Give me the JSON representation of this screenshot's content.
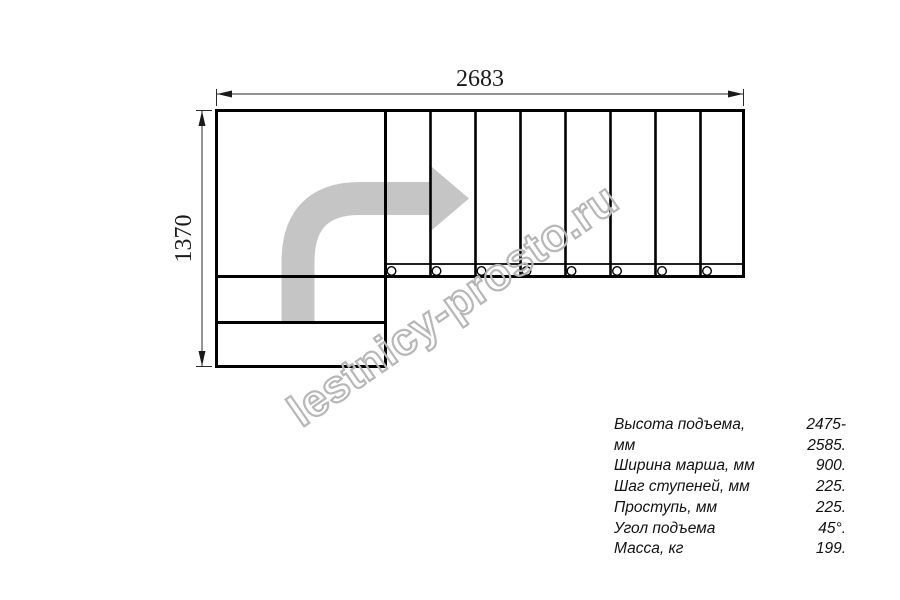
{
  "drawing": {
    "type": "l-shaped-staircase-plan-top-view",
    "dim_width": "2683",
    "dim_height": "1370",
    "treads_count": 8,
    "mount_holes_count": 8,
    "colors": {
      "line": "#000000",
      "dimension": "#2a2a2a",
      "arrow_fill": "#c5c5c5",
      "watermark": "#b7b7b7",
      "background": "#ffffff"
    }
  },
  "watermark": {
    "text": "lestnicy-prosto.ru"
  },
  "specs": {
    "rows": [
      {
        "label": "Высота подъема, мм",
        "value": "2475-2585."
      },
      {
        "label": "Ширина марша, мм",
        "value": "900."
      },
      {
        "label": "Шаг ступеней, мм",
        "value": "225."
      },
      {
        "label": "Проступь, мм",
        "value": "225."
      },
      {
        "label": "Угол подъема",
        "value": "45°."
      },
      {
        "label": "Масса, кг",
        "value": "199."
      }
    ]
  }
}
